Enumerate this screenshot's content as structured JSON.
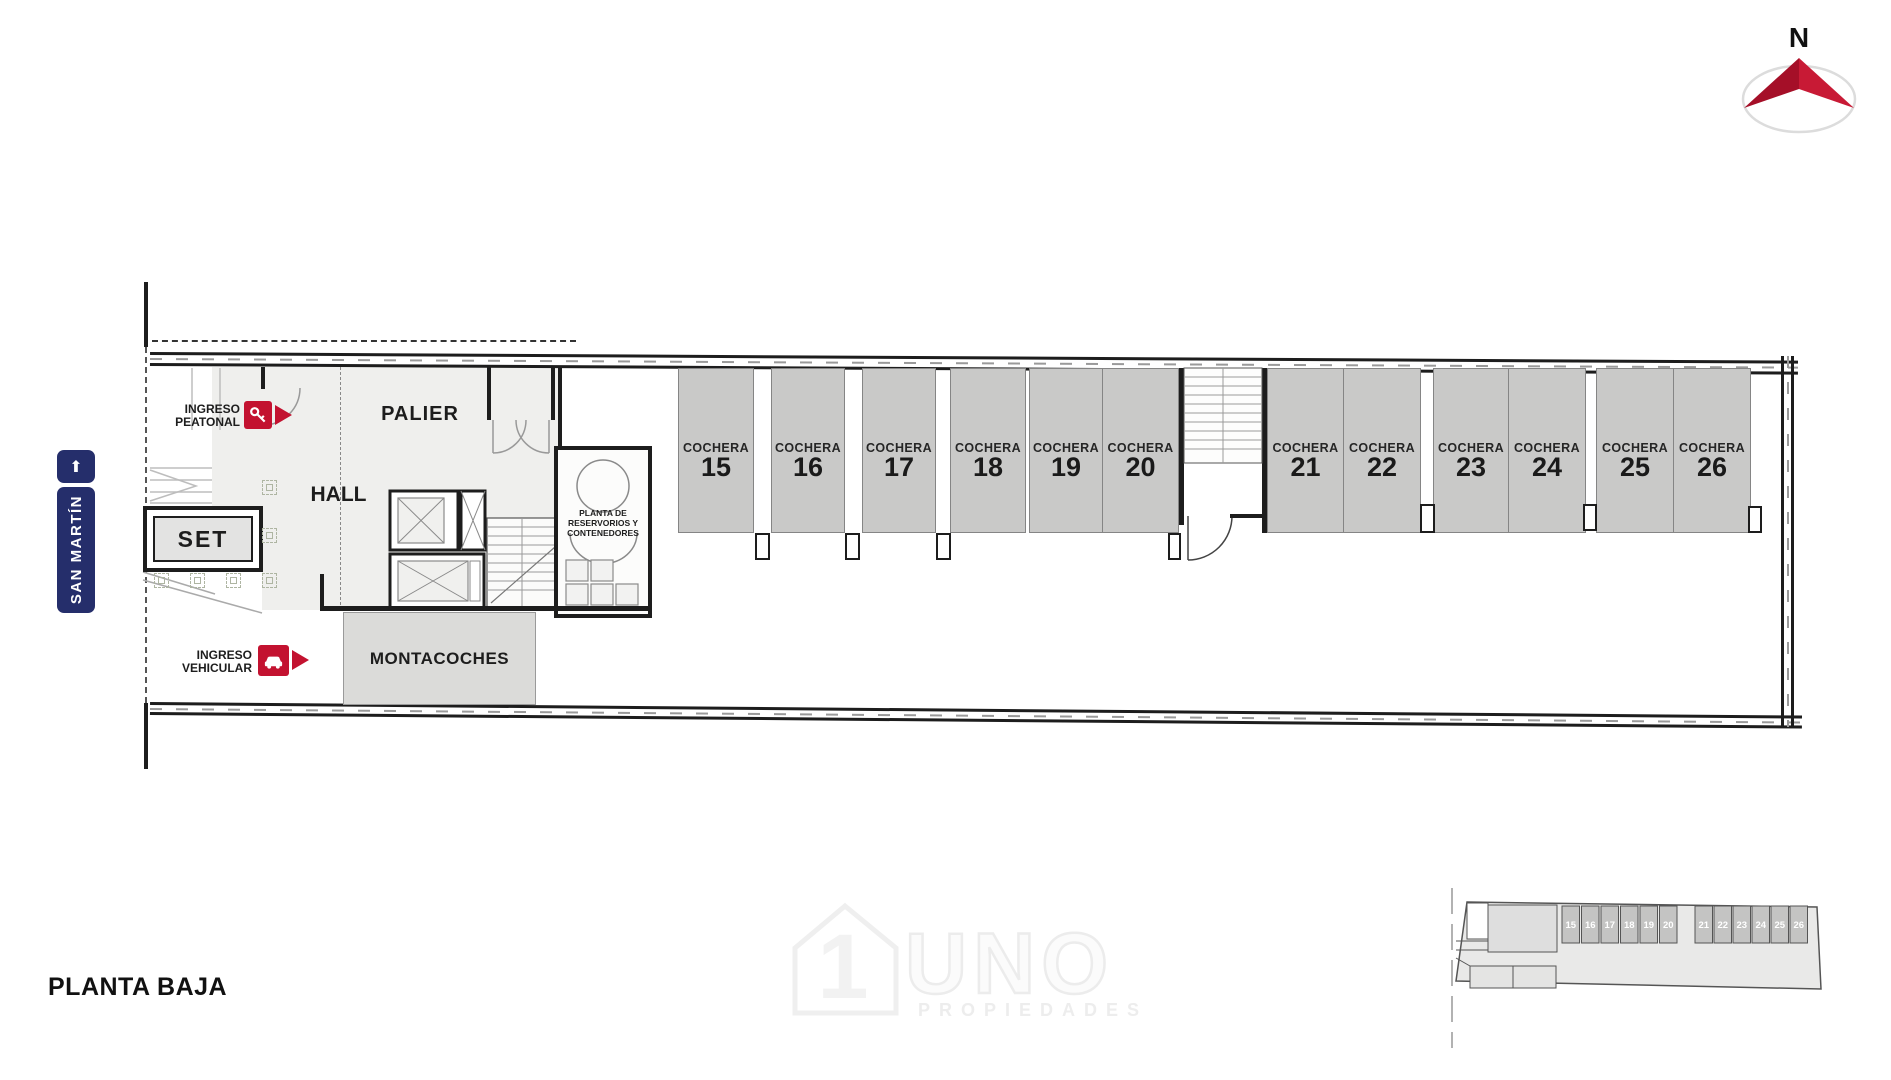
{
  "title": "PLANTA BAJA",
  "compass": {
    "label": "N"
  },
  "street_sign": {
    "name": "SAN MARTÍN",
    "arrow": "⬆"
  },
  "entrances": {
    "pedestrian": {
      "line1": "INGRESO",
      "line2": "PEATONAL"
    },
    "vehicular": {
      "line1": "INGRESO",
      "line2": "VEHICULAR"
    }
  },
  "rooms": {
    "hall": "HALL",
    "palier": "PALIER",
    "set": "SET",
    "montacoches": "MONTACOCHES",
    "reservorios_line1": "PLANTA DE",
    "reservorios_line2": "RESERVORIOS Y",
    "reservorios_line3": "CONTENEDORES"
  },
  "parking": {
    "stalls": [
      {
        "label": "COCHERA",
        "number": "15"
      },
      {
        "label": "COCHERA",
        "number": "16"
      },
      {
        "label": "COCHERA",
        "number": "17"
      },
      {
        "label": "COCHERA",
        "number": "18"
      },
      {
        "label": "COCHERA",
        "number": "19"
      },
      {
        "label": "COCHERA",
        "number": "20"
      },
      {
        "label": "COCHERA",
        "number": "21"
      },
      {
        "label": "COCHERA",
        "number": "22"
      },
      {
        "label": "COCHERA",
        "number": "23"
      },
      {
        "label": "COCHERA",
        "number": "24"
      },
      {
        "label": "COCHERA",
        "number": "25"
      },
      {
        "label": "COCHERA",
        "number": "26"
      }
    ]
  },
  "minimap": {
    "numbers": [
      "15",
      "16",
      "17",
      "18",
      "19",
      "20",
      "21",
      "22",
      "23",
      "24",
      "25",
      "26"
    ]
  },
  "watermark": {
    "number": "1",
    "brand": "UNO",
    "subtitle": "PROPIEDADES"
  },
  "colors": {
    "accent_red": "#c31230",
    "street_navy": "#252e6b",
    "stall_gray": "#c9c9c8",
    "wall_black": "#1d1d1d"
  }
}
